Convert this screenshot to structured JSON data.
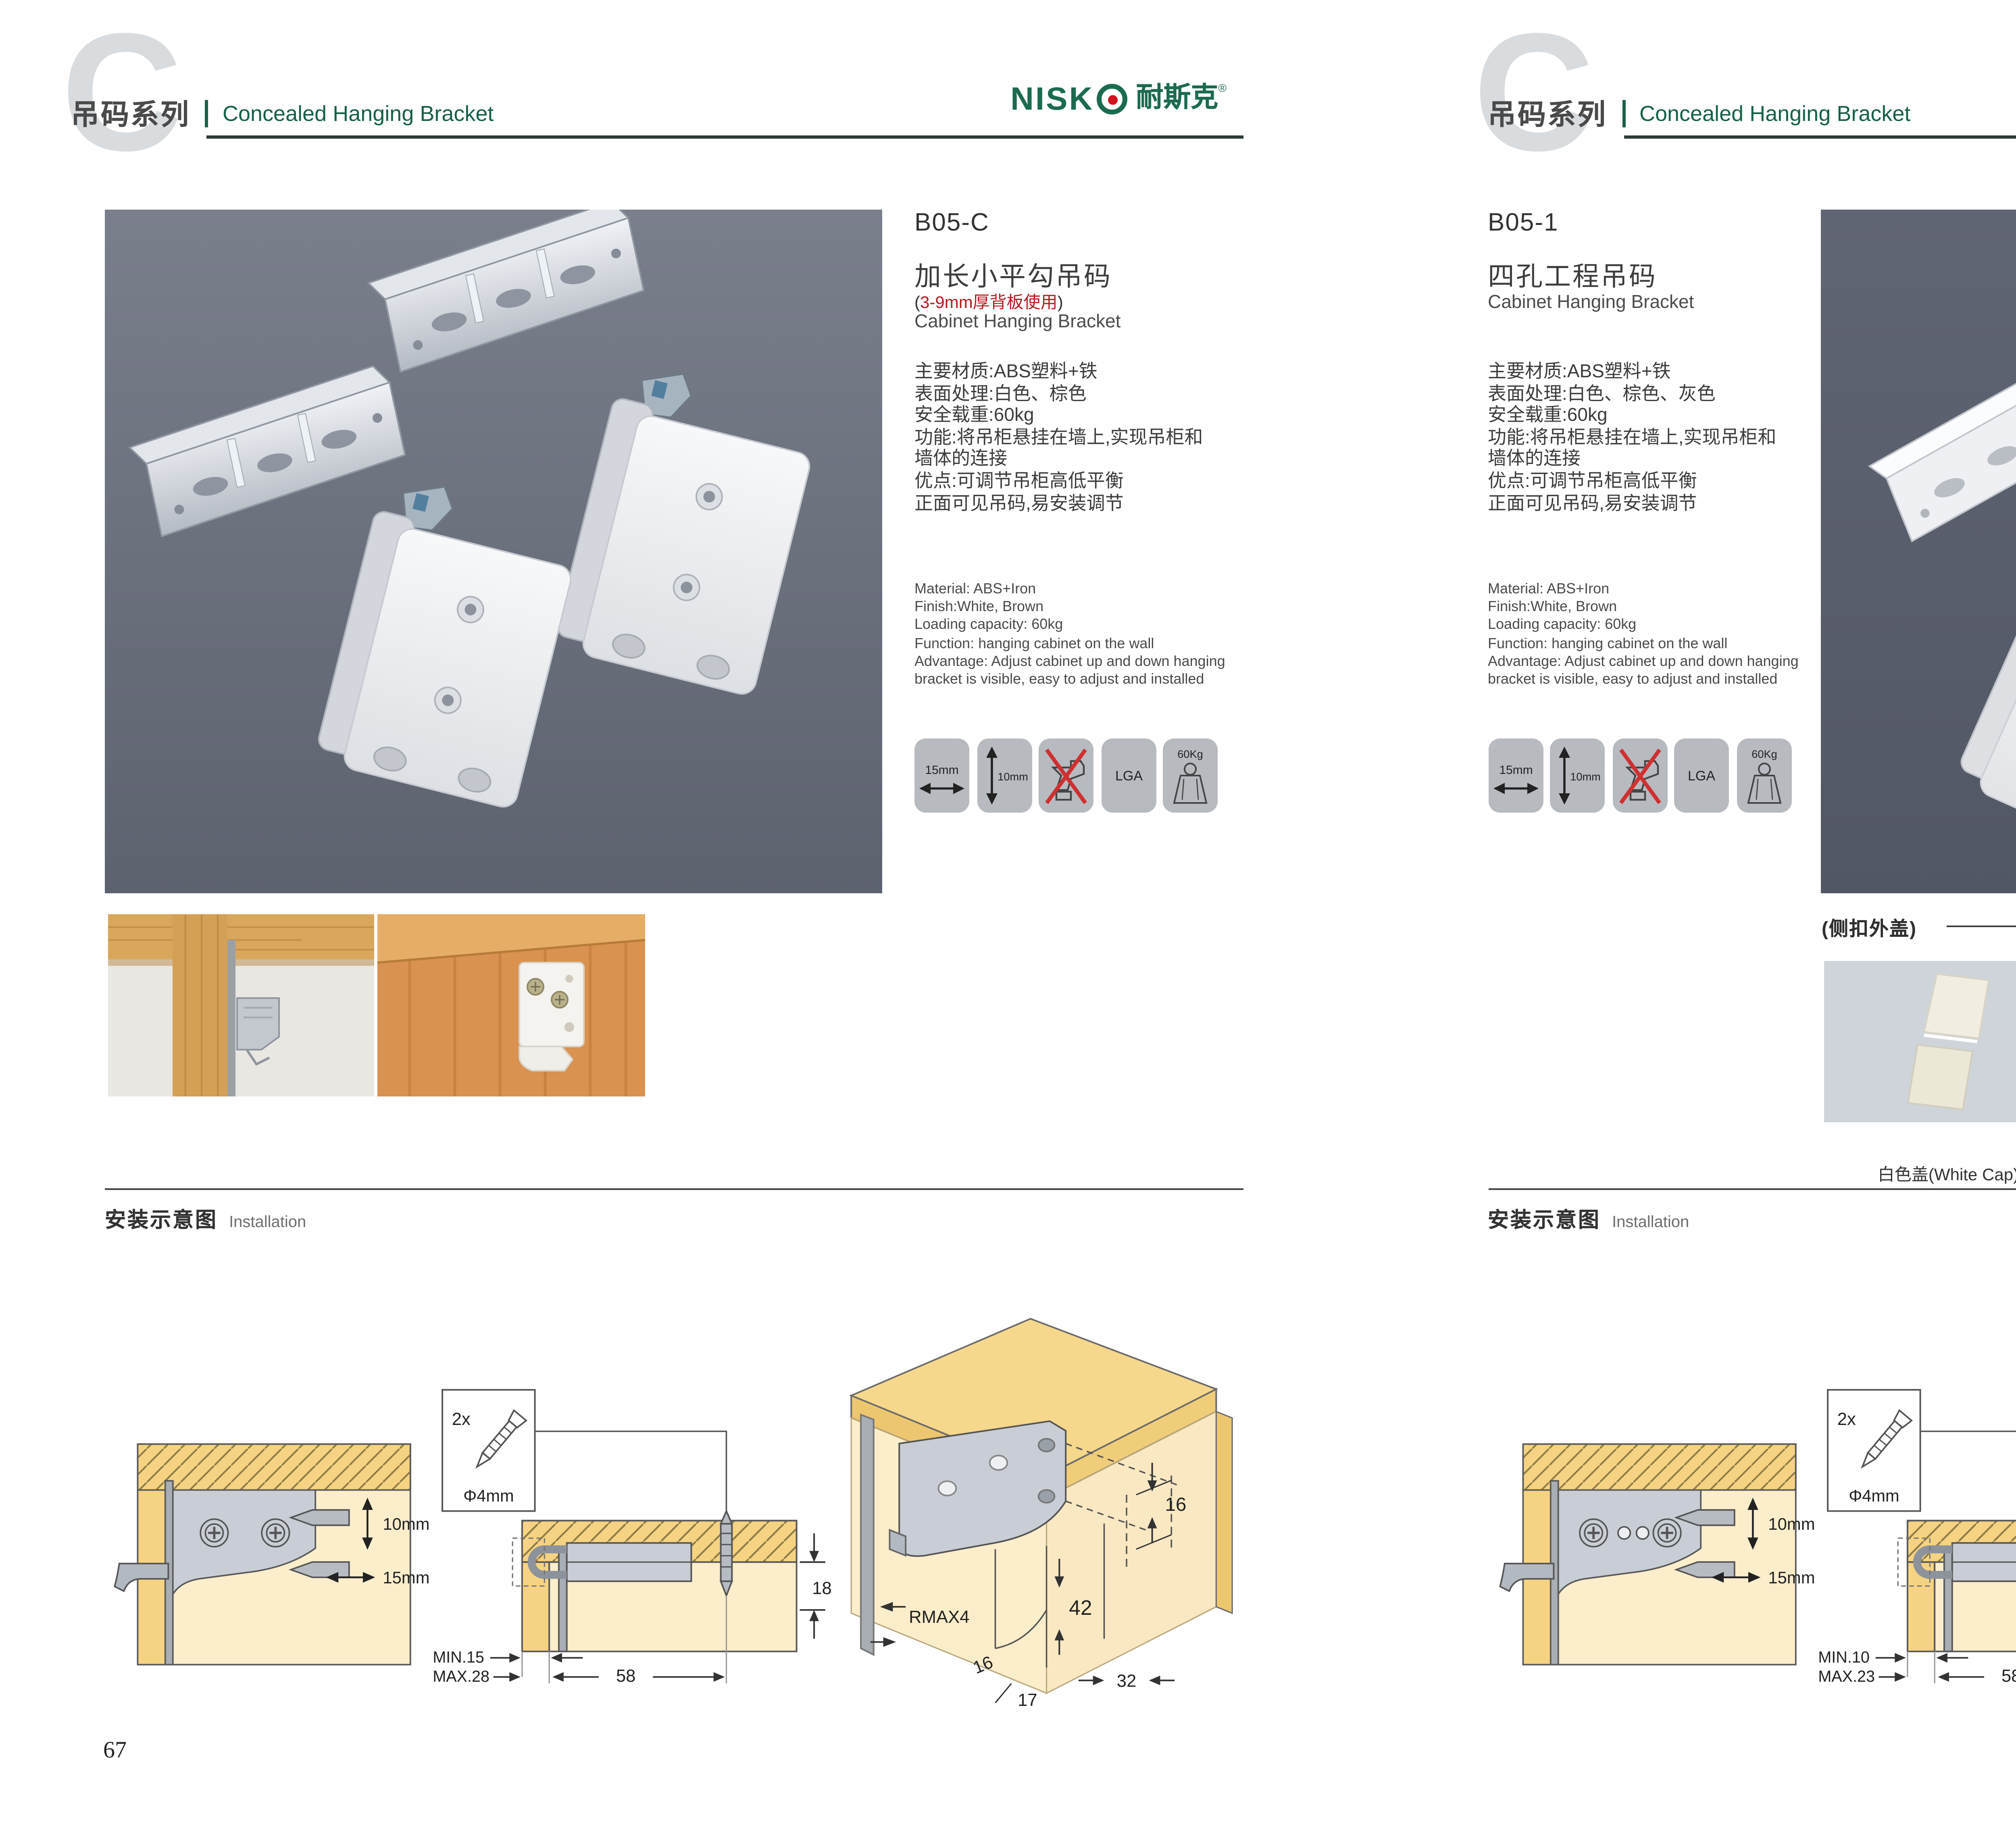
{
  "colors": {
    "accent_green": "#15604a",
    "logo_green": "#1b6b4f",
    "logo_dot_red": "#cf1420",
    "note_red": "#b5191f",
    "header_text": "#4a4a4a",
    "icon_bg": "#b7bbc0",
    "photo_bg_left": "#6d7280",
    "photo_bg_right": "#585d6b",
    "diagram_panel_yellow": "#f6d382",
    "diagram_interior": "#fcedcb",
    "diagram_metal": "#c9ced6",
    "cap_white": "#f1eee1",
    "cap_gray": "#b3b1a4",
    "cap_silver": "#c8683a"
  },
  "header": {
    "watermark": "C",
    "series_cn": "吊码系列",
    "series_en": "Concealed Hanging Bracket",
    "logo_en": "NISK",
    "logo_cn": "耐斯克",
    "logo_reg": "®"
  },
  "pages": [
    {
      "number": "67",
      "product": {
        "code": "B05-C",
        "name_cn": "加长小平勾吊码",
        "note_open": "(",
        "note_text": "3-9mm厚背板使用",
        "note_close": ")",
        "name_en": "Cabinet Hanging Bracket",
        "specs_cn": [
          "主要材质:ABS塑料+铁",
          "表面处理:白色、棕色",
          "安全载重:60kg",
          "功能:将吊柜悬挂在墙上,实现吊柜和",
          "墙体的连接",
          "优点:可调节吊柜高低平衡",
          "正面可见吊码,易安装调节"
        ],
        "specs_en": [
          "Material: ABS+Iron",
          "Finish:White, Brown",
          "Loading capacity: 60kg",
          "Function: hanging cabinet on the wall",
          "Advantage: Adjust cabinet up and down hanging",
          "bracket is visible, easy to adjust and installed"
        ],
        "icons": [
          {
            "name": "width-15mm",
            "label": "15mm"
          },
          {
            "name": "height-10mm",
            "label": "10mm"
          },
          {
            "name": "no-drill",
            "label": ""
          },
          {
            "name": "lga-cert",
            "label": "LGA"
          },
          {
            "name": "load-60kg",
            "label": "60Kg"
          }
        ]
      },
      "installation": {
        "title_cn": "安装示意图",
        "title_en": "Installation",
        "d1": {
          "dim_v": "10mm",
          "dim_h": "15mm"
        },
        "d2": {
          "qty": "2x",
          "dia": "Φ4mm",
          "depth": "18",
          "min": "MIN.15",
          "max": "MAX.28",
          "span": "58"
        },
        "d3": {
          "top": "16",
          "height": "42",
          "radius": "RMAX4",
          "b1": "16",
          "b2": "17",
          "b3": "32"
        }
      }
    },
    {
      "number": "68",
      "product": {
        "code": "B05-1",
        "name_cn": "四孔工程吊码",
        "name_en": "Cabinet Hanging Bracket",
        "specs_cn": [
          "主要材质:ABS塑料+铁",
          "表面处理:白色、棕色、灰色",
          "安全载重:60kg",
          "功能:将吊柜悬挂在墙上,实现吊柜和",
          "墙体的连接",
          "优点:可调节吊柜高低平衡",
          "正面可见吊码,易安装调节"
        ],
        "specs_en": [
          "Material: ABS+Iron",
          "Finish:White, Brown",
          "Loading capacity: 60kg",
          "Function: hanging cabinet on the wall",
          "Advantage: Adjust cabinet up and down hanging",
          "bracket is visible, easy to adjust and installed"
        ],
        "icons": [
          {
            "name": "width-15mm",
            "label": "15mm"
          },
          {
            "name": "height-10mm",
            "label": "10mm"
          },
          {
            "name": "no-drill",
            "label": ""
          },
          {
            "name": "lga-cert",
            "label": "LGA"
          },
          {
            "name": "load-60kg",
            "label": "60Kg"
          }
        ]
      },
      "caps": {
        "title": "(侧扣外盖)",
        "items": [
          {
            "label": "白色盖(White Cap)"
          },
          {
            "label": "灰色盖(Gray Cap)"
          },
          {
            "label": "棕色盖(Silver Cap)"
          }
        ]
      },
      "installation": {
        "title_cn": "安装示意图",
        "title_en": "Installation",
        "d1": {
          "dim_v": "10mm",
          "dim_h": "15mm"
        },
        "d2": {
          "qty": "2x",
          "dia": "Φ4mm",
          "depth": "18",
          "min": "MIN.10",
          "max": "MAX.23",
          "span": "58"
        },
        "d3": {
          "top": "16",
          "height": "42",
          "radius": "RMAX4",
          "b1": "16",
          "b2": "17",
          "b3": "32"
        }
      }
    }
  ]
}
